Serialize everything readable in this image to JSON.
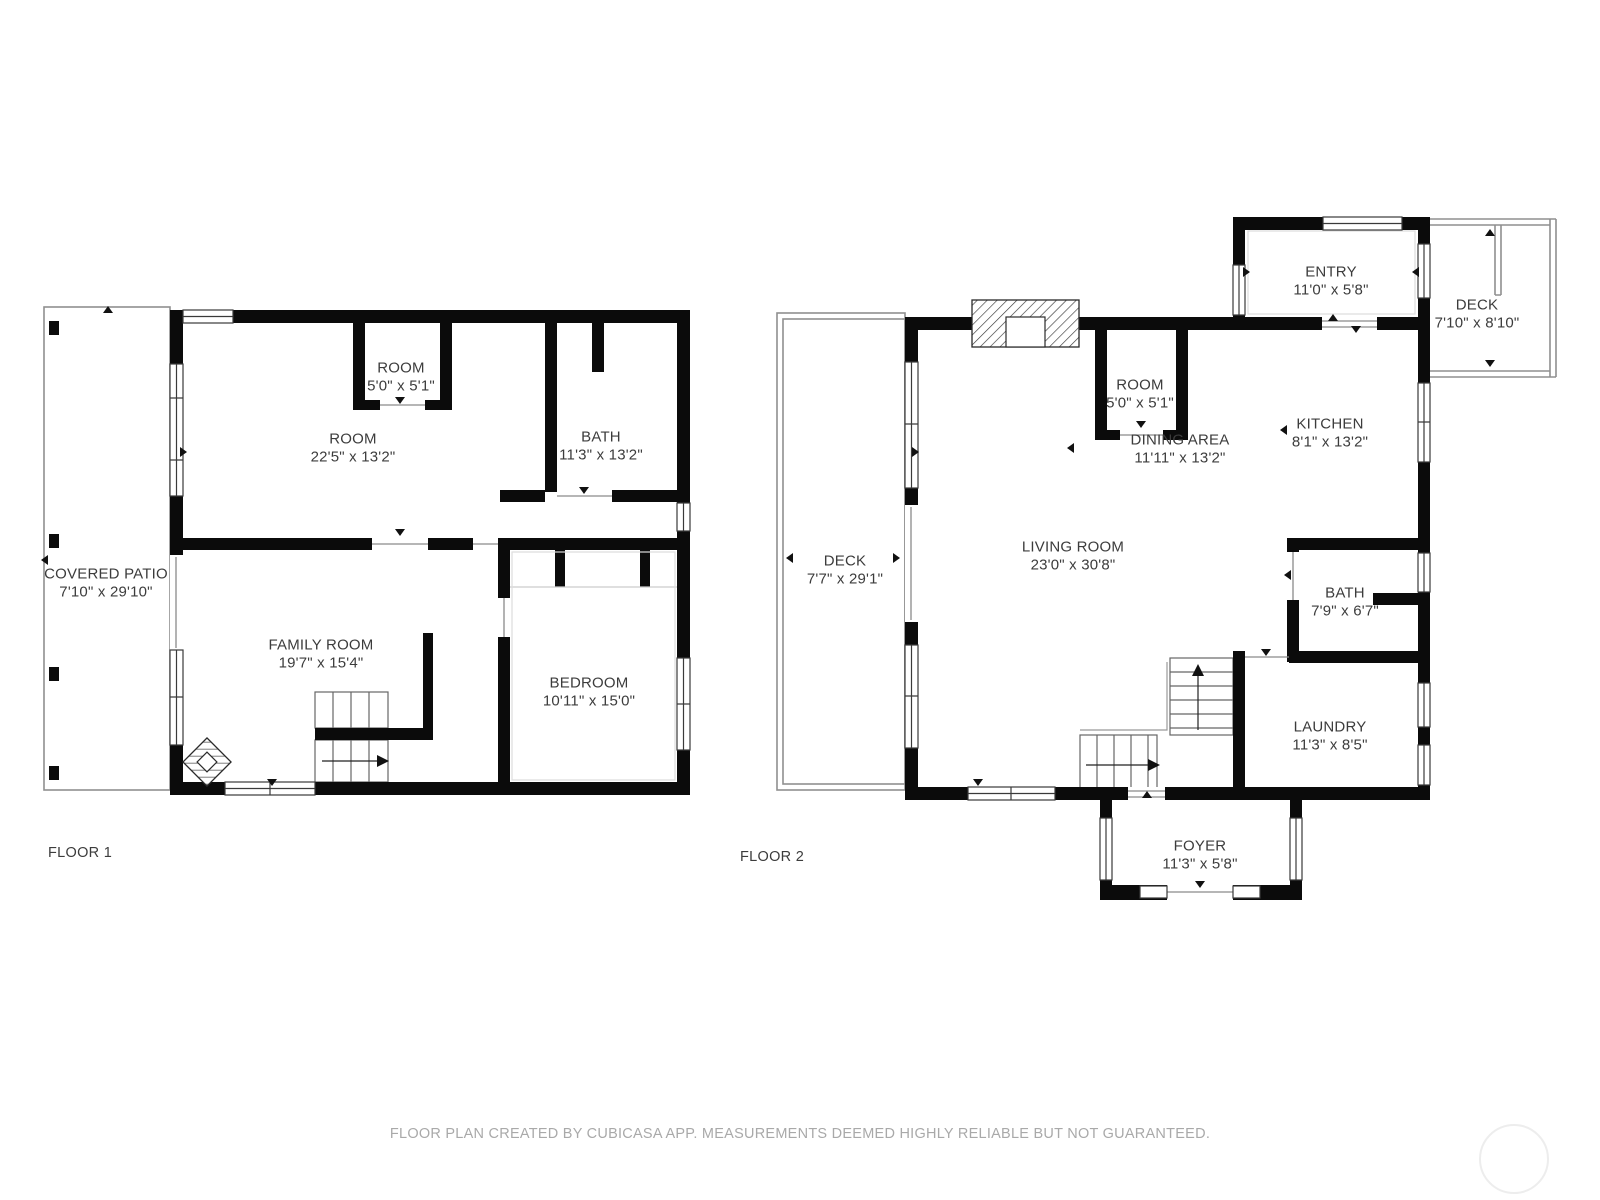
{
  "floor1": {
    "title": "FLOOR 1",
    "rooms": {
      "covered_patio": {
        "name": "COVERED PATIO",
        "dims": "7'10\" x 29'10\""
      },
      "room_large": {
        "name": "ROOM",
        "dims": "22'5\" x 13'2\""
      },
      "room_small": {
        "name": "ROOM",
        "dims": "5'0\" x 5'1\""
      },
      "bath": {
        "name": "BATH",
        "dims": "11'3\" x 13'2\""
      },
      "family_room": {
        "name": "FAMILY ROOM",
        "dims": "19'7\" x 15'4\""
      },
      "bedroom": {
        "name": "BEDROOM",
        "dims": "10'11\" x 15'0\""
      }
    }
  },
  "floor2": {
    "title": "FLOOR 2",
    "rooms": {
      "entry": {
        "name": "ENTRY",
        "dims": "11'0\" x 5'8\""
      },
      "deck_upper": {
        "name": "DECK",
        "dims": "7'10\" x 8'10\""
      },
      "room": {
        "name": "ROOM",
        "dims": "5'0\" x 5'1\""
      },
      "dining_area": {
        "name": "DINING AREA",
        "dims": "11'11\" x 13'2\""
      },
      "kitchen": {
        "name": "KITCHEN",
        "dims": "8'1\" x 13'2\""
      },
      "deck_side": {
        "name": "DECK",
        "dims": "7'7\" x 29'1\""
      },
      "living_room": {
        "name": "LIVING ROOM",
        "dims": "23'0\" x 30'8\""
      },
      "bath": {
        "name": "BATH",
        "dims": "7'9\" x 6'7\""
      },
      "laundry": {
        "name": "LAUNDRY",
        "dims": "11'3\" x 8'5\""
      },
      "foyer": {
        "name": "FOYER",
        "dims": "11'3\" x 5'8\""
      }
    }
  },
  "footer": {
    "disclaimer": "FLOOR PLAN CREATED BY CUBICASA APP. MEASUREMENTS DEEMED HIGHLY RELIABLE BUT NOT GUARANTEED."
  },
  "colors": {
    "wall": "#0b0b0b",
    "label": "#3c3c3c",
    "thin_outline": "#8f8f8f",
    "footer_text": "#a9a9a9"
  }
}
